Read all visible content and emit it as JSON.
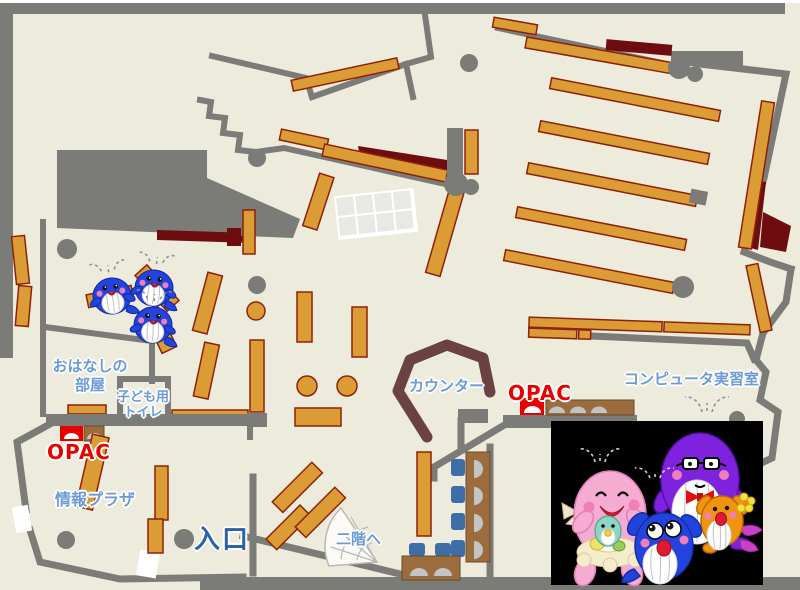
{
  "labels": {
    "storytelling_line1": "おはなしの",
    "storytelling_line2": "部屋",
    "kids_toilet_line1": "子ども用",
    "kids_toilet_line2": "トイレ",
    "opac_left": "OPAC",
    "opac_right": "OPAC",
    "info_plaza": "情報プラザ",
    "entrance": "入口",
    "counter": "カウンター",
    "computer_room": "コンピュータ実習室",
    "to_second_floor": "二階へ"
  },
  "colors": {
    "floor": "#ECEBDC",
    "wall": "#7B7B77",
    "shelf": "#DB9C35",
    "shelf_outline": "#8F2108",
    "dark_red": "#6E0D10",
    "counter": "#6B4242",
    "grid_table": "#E8E8E5",
    "chair_blue": "#3D6EA8",
    "desk_brown": "#9A6C3E",
    "monitor_gray": "#C4C4C4",
    "photo_bg": "#000000",
    "label_blue": "#6D9AD6",
    "entrance_blue": "#2E61AC",
    "opac_red": "#E80000",
    "whale_blue": "#2244DD",
    "mascot_pink": "#F5ABD2",
    "mascot_blue": "#2244DD",
    "mascot_purple": "#7F22DD",
    "mascot_orange": "#F0930F",
    "baby_green": "#8ED6C4"
  },
  "mascots": {
    "play_area": [
      "small-blue-whale",
      "small-blue-whale",
      "small-blue-whale"
    ],
    "photo_left_to_right": [
      "pink-whale",
      "blue-whale",
      "purple-whale",
      "orange-whale"
    ]
  }
}
